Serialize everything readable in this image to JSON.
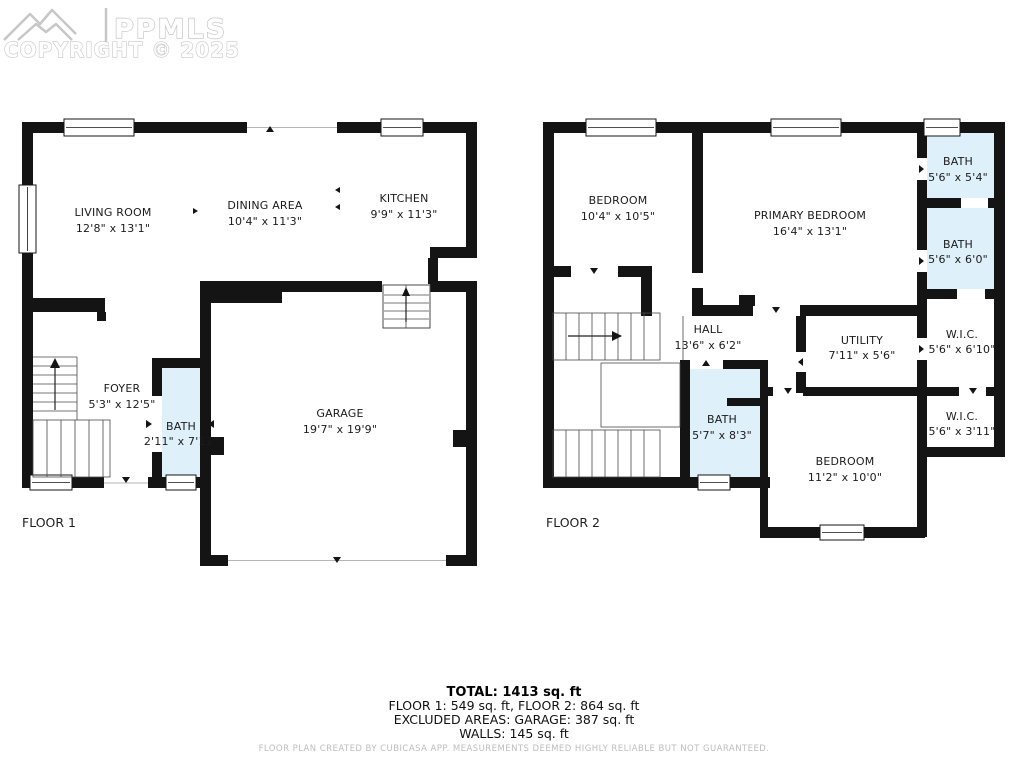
{
  "watermark": {
    "brand": "PPMLS",
    "copyright": "COPYRIGHT © 2025"
  },
  "floor1": {
    "label": "FLOOR 1",
    "rooms": {
      "living": {
        "name": "LIVING ROOM",
        "dims": "12'8\" x 13'1\""
      },
      "dining": {
        "name": "DINING AREA",
        "dims": "10'4\" x 11'3\""
      },
      "kitchen": {
        "name": "KITCHEN",
        "dims": "9'9\" x 11'3\""
      },
      "foyer": {
        "name": "FOYER",
        "dims": "5'3\" x 12'5\""
      },
      "bath": {
        "name": "BATH",
        "dims": "2'11\" x 7'11\""
      },
      "garage": {
        "name": "GARAGE",
        "dims": "19'7\" x 19'9\""
      }
    }
  },
  "floor2": {
    "label": "FLOOR 2",
    "rooms": {
      "bedroom1": {
        "name": "BEDROOM",
        "dims": "10'4\" x 10'5\""
      },
      "primary": {
        "name": "PRIMARY BEDROOM",
        "dims": "16'4\" x 13'1\""
      },
      "bath1": {
        "name": "BATH",
        "dims": "5'6\" x 5'4\""
      },
      "bath2": {
        "name": "BATH",
        "dims": "5'6\" x 6'0\""
      },
      "wic1": {
        "name": "W.I.C.",
        "dims": "5'6\" x 6'10\""
      },
      "utility": {
        "name": "UTILITY",
        "dims": "7'11\" x 5'6\""
      },
      "hall": {
        "name": "HALL",
        "dims": "13'6\" x 6'2\""
      },
      "bath3": {
        "name": "BATH",
        "dims": "5'7\" x 8'3\""
      },
      "wic2": {
        "name": "W.I.C.",
        "dims": "5'6\" x 3'11\""
      },
      "bedroom2": {
        "name": "BEDROOM",
        "dims": "11'2\" x 10'0\""
      }
    }
  },
  "summary": {
    "total": "TOTAL: 1413 sq. ft",
    "floors": "FLOOR 1: 549 sq. ft, FLOOR 2: 864 sq. ft",
    "excluded": "EXCLUDED AREAS: GARAGE: 387 sq. ft",
    "walls": "WALLS: 145 sq. ft",
    "disclaimer": "FLOOR PLAN CREATED BY CUBICASA APP. MEASUREMENTS DEEMED HIGHLY RELIABLE BUT NOT GUARANTEED."
  },
  "colors": {
    "wall": "#141414",
    "bath_fill": "#def0fa",
    "watermark": "#c7c7c7",
    "disclaimer_text": "#bdbdbd"
  }
}
